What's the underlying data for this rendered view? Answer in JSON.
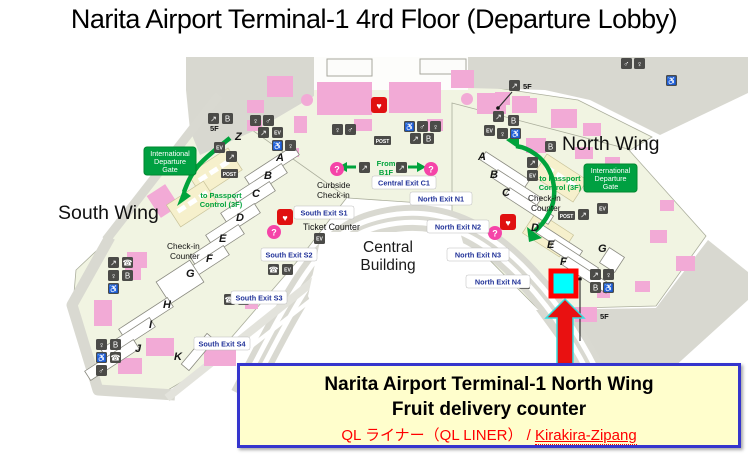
{
  "title": "Narita Airport Terminal-1 4rd Floor (Departure Lobby)",
  "map": {
    "south_wing_label": "South Wing",
    "north_wing_label": "North Wing",
    "central_building": {
      "line1": "Central",
      "line2": "Building"
    },
    "gate": {
      "line1": "International",
      "line2": "Departure",
      "line3": "Gate"
    },
    "passport": {
      "line1": "to Passport",
      "line2": "Control (3F)"
    },
    "checkin": {
      "line1": "Check-in",
      "line2": "Counter"
    },
    "curbside": {
      "line1": "Curbside",
      "line2": "Check-in"
    },
    "ticket_counter": "Ticket Counter",
    "from_b1f": {
      "line1": "From",
      "line2": "B1F"
    },
    "floor_label_5f": "5F",
    "exits": {
      "central_c1": "Central Exit C1",
      "south_s1": "South Exit S1",
      "south_s2": "South Exit S2",
      "south_s3": "South Exit S3",
      "south_s4": "South Exit S4",
      "north_n1": "North Exit N1",
      "north_n2": "North Exit N2",
      "north_n3": "North Exit N3",
      "north_n4": "North Exit N4"
    },
    "islands_south": [
      "Z",
      "A",
      "B",
      "C",
      "D",
      "E",
      "F",
      "G",
      "H",
      "I",
      "J",
      "K"
    ],
    "islands_north": [
      "A",
      "B",
      "C",
      "D",
      "E",
      "F",
      "G"
    ],
    "colors": {
      "floor": "#F1F4E2",
      "road_gray": "#D8D8D0",
      "shop_pink": "#F2AAD6",
      "gate_green": "#00A041",
      "exit_text_blue": "#223399",
      "highlight_fill": "#00FFFF",
      "highlight_border": "#FF0000",
      "arrow_red": "#E91111"
    }
  },
  "icons": {
    "escalator": "↗",
    "restroom_female": "♀",
    "restroom_male": "♂",
    "wheelchair": "♿",
    "phone": "☎",
    "elevator": "EV",
    "baggage": "B",
    "aed": "♥",
    "information": "?",
    "post": "POST"
  },
  "annotation": {
    "line1": "Narita Airport Terminal-1 North Wing",
    "line2": "Fruit delivery counter",
    "line3_prefix": "QL ライナー（QL LINER） / ",
    "line3_link": "Kirakira-Zipang"
  }
}
